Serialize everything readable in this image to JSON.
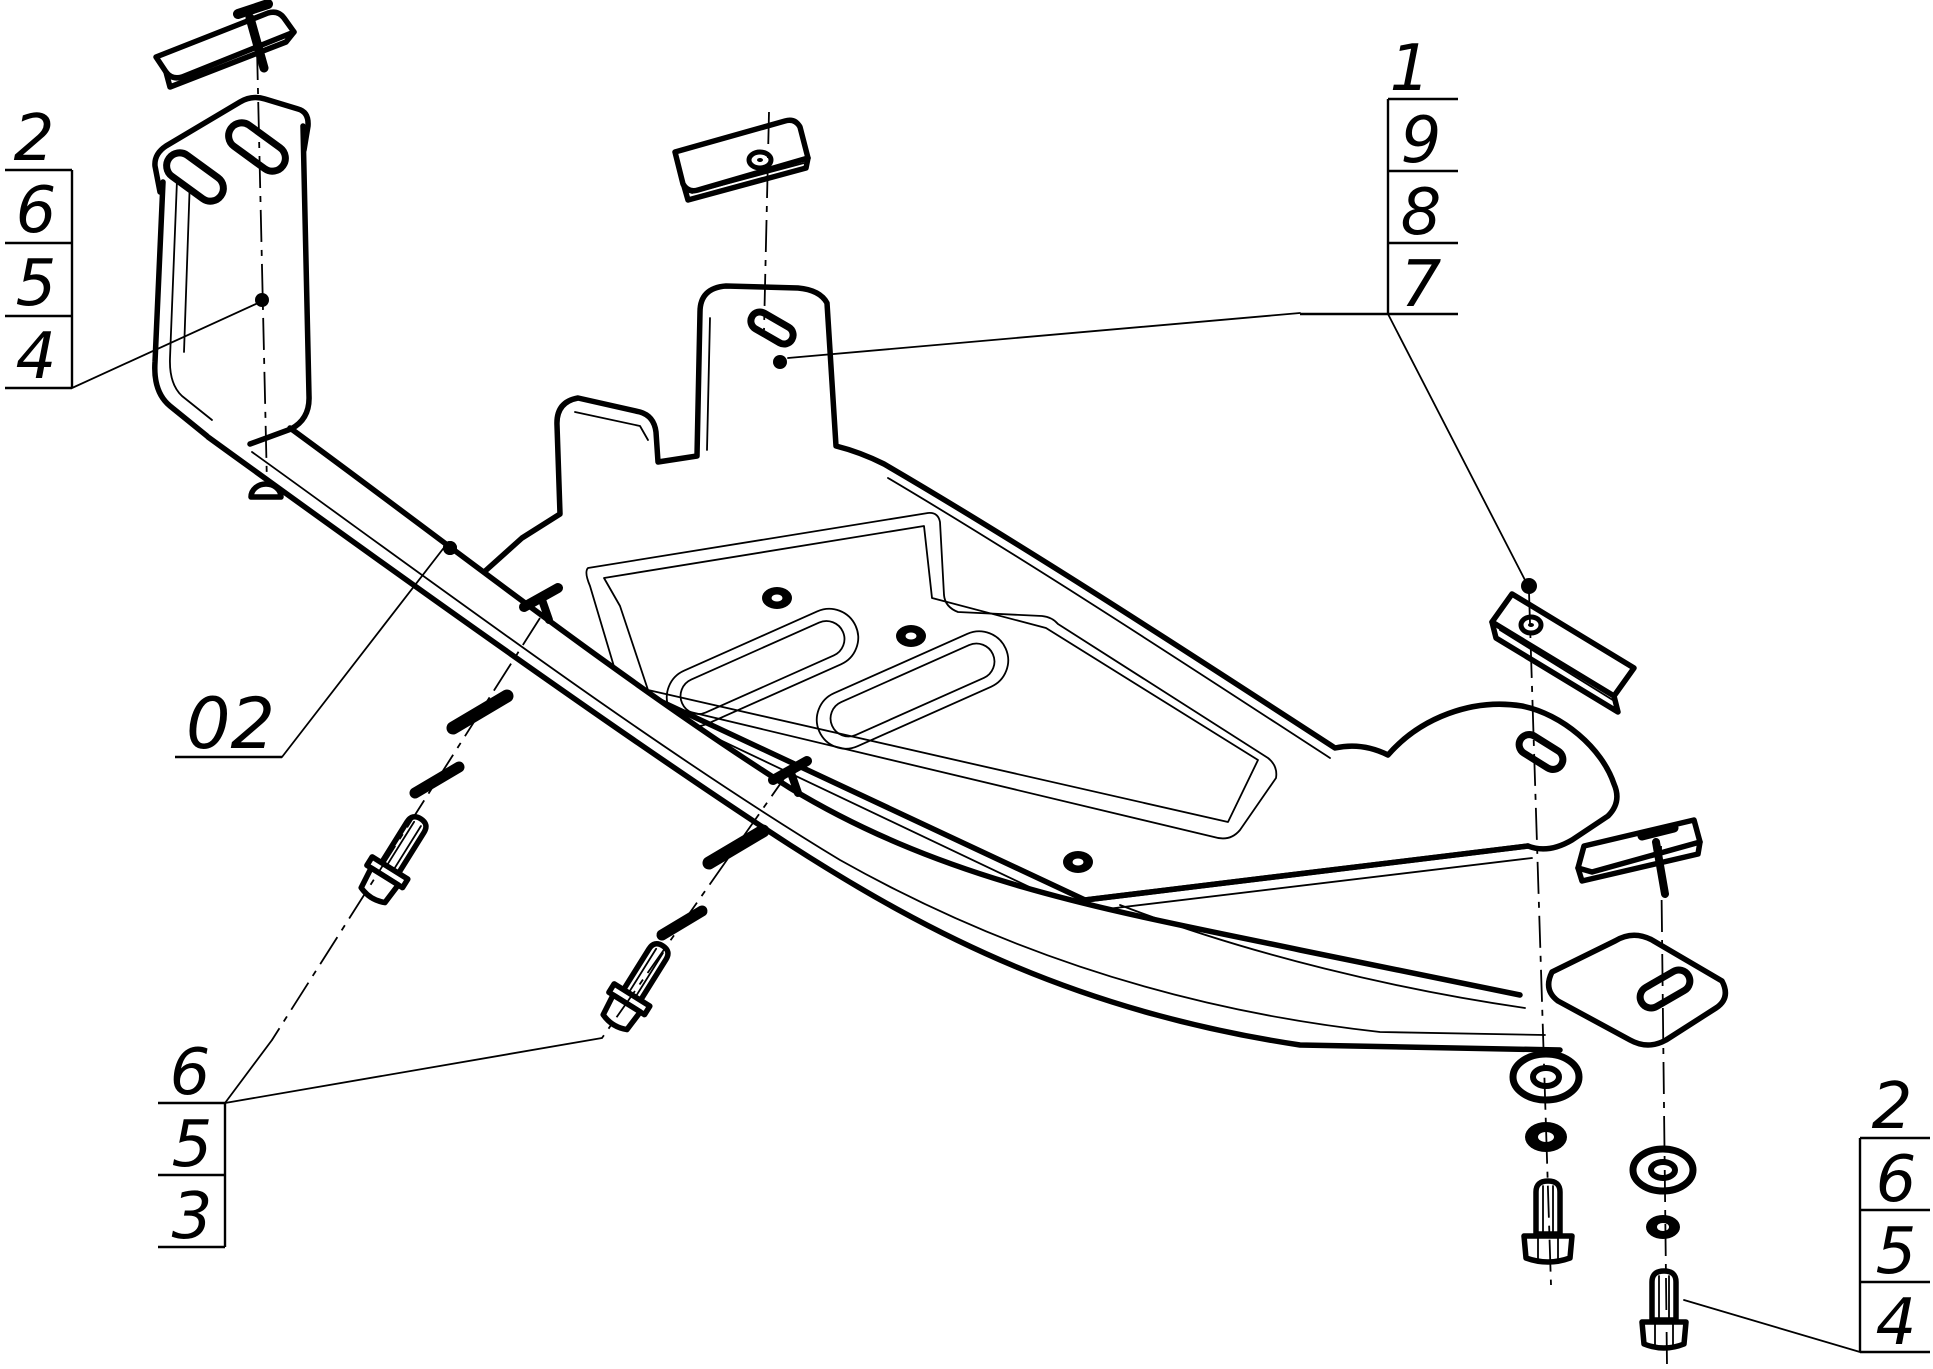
{
  "drawing": {
    "type": "exploded-assembly-technical-drawing",
    "colors": {
      "ink": "#000000",
      "paper": "#ffffff"
    },
    "callouts": {
      "top_left": {
        "header": "2",
        "rows": [
          "6",
          "5",
          "4"
        ]
      },
      "top_right": {
        "header": "1",
        "rows": [
          "9",
          "8",
          "7"
        ]
      },
      "bottom_left": {
        "header": "6",
        "rows": [
          "5",
          "3"
        ]
      },
      "bottom_right": {
        "header": "2",
        "rows": [
          "6",
          "5",
          "4"
        ]
      },
      "assembly_label": "02"
    }
  }
}
